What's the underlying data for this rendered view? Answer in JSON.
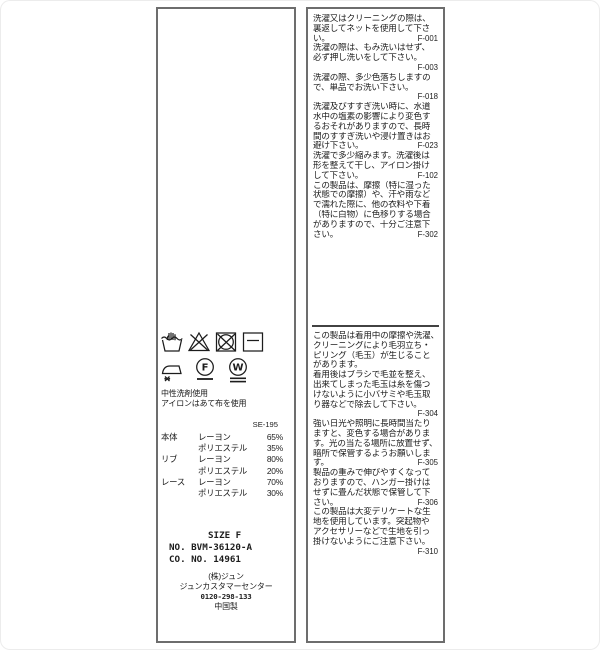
{
  "right_label": {
    "top_lines": [
      {
        "t": "洗濯又はクリーニングの際は、",
        "c": ""
      },
      {
        "t": "裏返してネットを使用して下さ",
        "c": ""
      },
      {
        "t": "い。",
        "c": "F-001"
      },
      {
        "t": "洗濯の際は、もみ洗いはせず、",
        "c": ""
      },
      {
        "t": "必ず押し洗いをして下さい。",
        "c": ""
      },
      {
        "t": "",
        "c": "F-003"
      },
      {
        "t": "洗濯の際、多少色落ちしますの",
        "c": ""
      },
      {
        "t": "で、単品でお洗い下さい。",
        "c": ""
      },
      {
        "t": "",
        "c": "F-018"
      },
      {
        "t": "洗濯及びすすぎ洗い時に、水道",
        "c": ""
      },
      {
        "t": "水中の塩素の影響により変色す",
        "c": ""
      },
      {
        "t": "るおそれがありますので、長時",
        "c": ""
      },
      {
        "t": "間のすすぎ洗いや浸け置きはお",
        "c": ""
      },
      {
        "t": "避け下さい。",
        "c": "F-023"
      },
      {
        "t": "洗濯で多少縮みます。洗濯後は",
        "c": ""
      },
      {
        "t": "形を整えて干し、アイロン掛け",
        "c": ""
      },
      {
        "t": "して下さい。",
        "c": "F-102"
      },
      {
        "t": "この製品は、摩擦（特に湿った",
        "c": ""
      },
      {
        "t": "状態での摩擦）や、汗や雨など",
        "c": ""
      },
      {
        "t": "で濡れた際に、他の衣料や下着",
        "c": ""
      },
      {
        "t": "（特に白物）に色移りする場合",
        "c": ""
      },
      {
        "t": "がありますので、十分ご注意下",
        "c": ""
      },
      {
        "t": "さい。",
        "c": "F-302"
      }
    ],
    "bottom_lines": [
      {
        "t": "この製品は着用中の摩擦や洗濯、",
        "c": ""
      },
      {
        "t": "クリーニングにより毛羽立ち・",
        "c": ""
      },
      {
        "t": "ピリング（毛玉）が生じること",
        "c": ""
      },
      {
        "t": "があります。",
        "c": ""
      },
      {
        "t": "着用後はブラシで毛並を整え、",
        "c": ""
      },
      {
        "t": "出来てしまった毛玉は糸を傷つ",
        "c": ""
      },
      {
        "t": "けないように小バサミや毛玉取",
        "c": ""
      },
      {
        "t": "り器などで除去して下さい。",
        "c": ""
      },
      {
        "t": "",
        "c": "F-304"
      },
      {
        "t": "強い日光や照明に長時間当たり",
        "c": ""
      },
      {
        "t": "ますと、変色する場合がありま",
        "c": ""
      },
      {
        "t": "す。光の当たる場所に放置せず、",
        "c": ""
      },
      {
        "t": "暗所で保管するようお願いしま",
        "c": ""
      },
      {
        "t": "す。",
        "c": "F-305"
      },
      {
        "t": "製品の重みで伸びやすくなって",
        "c": ""
      },
      {
        "t": "おりますので、ハンガー掛けは",
        "c": ""
      },
      {
        "t": "せずに畳んだ状態で保管して下",
        "c": ""
      },
      {
        "t": "さい。",
        "c": "F-306"
      },
      {
        "t": "この製品は大変デリケートな生",
        "c": ""
      },
      {
        "t": "地を使用しています。突起物や",
        "c": ""
      },
      {
        "t": "アクセサリーなどで生地を引っ",
        "c": ""
      },
      {
        "t": "掛けないようにご注意下さい。",
        "c": ""
      },
      {
        "t": "",
        "c": "F-310"
      }
    ]
  },
  "left_label": {
    "care_symbols_row1": [
      "hand-wash",
      "do-not-bleach",
      "do-not-tumble-dry",
      "dry-flat"
    ],
    "care_symbols_row2": [
      "iron-low-no-steam",
      "dry-clean-petroleum-gentle",
      "wet-clean-very-gentle"
    ],
    "notes": [
      "中性洗剤使用",
      "アイロンはあて布を使用"
    ],
    "ref_code": "SE-195",
    "composition": [
      {
        "part": "本体",
        "fiber": "レーヨン",
        "pct": "65%"
      },
      {
        "part": "",
        "fiber": "ポリエステル",
        "pct": "35%"
      },
      {
        "part": "リブ",
        "fiber": "レーヨン",
        "pct": "80%"
      },
      {
        "part": "",
        "fiber": "ポリエステル",
        "pct": "20%"
      },
      {
        "part": "レース",
        "fiber": "レーヨン",
        "pct": "70%"
      },
      {
        "part": "",
        "fiber": "ポリエステル",
        "pct": "30%"
      }
    ],
    "size_label": "SIZE F",
    "product_no": "NO. BVM-36120-A",
    "co_no": "CO. NO.  14961",
    "company": "(株)ジュン",
    "customer_center": "ジュンカスタマーセンター",
    "phone": "0120-298-133",
    "origin": "中国製"
  },
  "colors": {
    "border": "#6d6d6d",
    "divider": "#424242",
    "text": "#1c1c1c",
    "background": "#ffffff"
  }
}
